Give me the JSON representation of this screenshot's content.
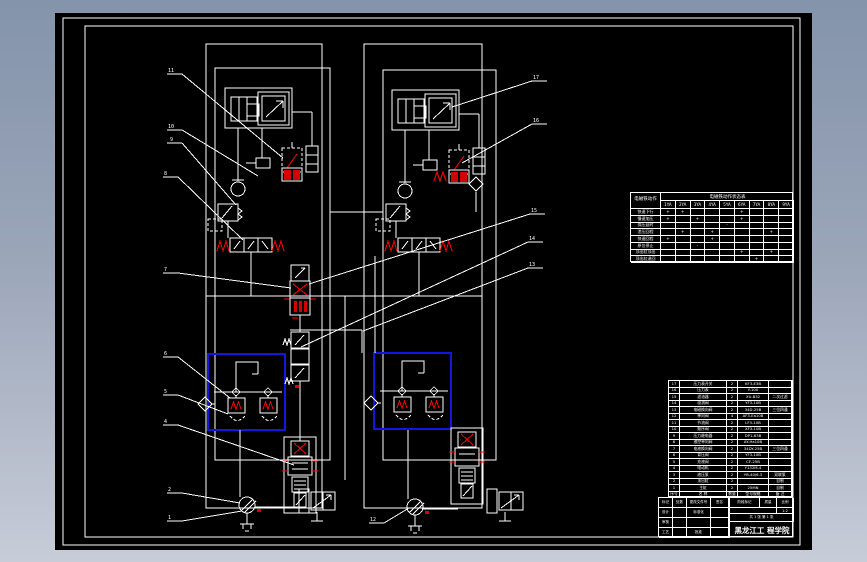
{
  "colors": {
    "background_top": "#8494ab",
    "background_bottom": "#c7ccd8",
    "paper": "#000000",
    "line": "#ffffff",
    "accent_red": "#ff0000",
    "highlight_blue": "#1515dd"
  },
  "callouts": [
    {
      "t": "11"
    },
    {
      "t": "10"
    },
    {
      "t": "9"
    },
    {
      "t": "8"
    },
    {
      "t": "7"
    },
    {
      "t": "6"
    },
    {
      "t": "5"
    },
    {
      "t": "4"
    },
    {
      "t": "2"
    },
    {
      "t": "1"
    },
    {
      "t": "17"
    },
    {
      "t": "16"
    },
    {
      "t": "15"
    },
    {
      "t": "14"
    },
    {
      "t": "13"
    },
    {
      "t": "12"
    }
  ],
  "action": {
    "corner": "电磁铁动作",
    "title": "电磁铁动作状态表",
    "head": [
      [
        "1YA",
        "2YA",
        "3YA",
        "4YA",
        "5YA",
        "6YA",
        "7YA",
        "8YA",
        "9YA"
      ]
    ],
    "rows": [
      [
        "快速下行",
        "+",
        "+",
        "",
        "",
        "",
        "+",
        "",
        "",
        ""
      ],
      [
        "慢速加压",
        "+",
        "",
        "+",
        "",
        "",
        "+",
        "",
        "",
        ""
      ],
      [
        "保压延时",
        "",
        "",
        "",
        "",
        "-",
        "",
        "",
        "",
        ""
      ],
      [
        "泄压回程",
        "",
        "+",
        "",
        "+",
        "",
        "",
        "",
        "+",
        ""
      ],
      [
        "快速回程",
        "+",
        "",
        "",
        "+",
        "",
        "",
        "",
        "",
        ""
      ],
      [
        "原位停止",
        "",
        "",
        "-",
        "",
        "",
        "",
        "",
        "",
        ""
      ],
      [
        "顶出缸顶出",
        "",
        "",
        "",
        "",
        "",
        "+",
        "",
        "+",
        ""
      ],
      [
        "顶出缸退回",
        "",
        "",
        "",
        "",
        "",
        "",
        "+",
        "",
        ""
      ]
    ]
  },
  "parts": {
    "rows": [
      [
        "17",
        "压力表开关",
        "2",
        "KF3-E3B",
        ""
      ],
      [
        "16",
        "压力表",
        "2",
        "Y-100",
        ""
      ],
      [
        "15",
        "滤油器",
        "2",
        "XU-B32",
        "二次过滤"
      ],
      [
        "14",
        "溢流阀",
        "2",
        "YF3-10B",
        ""
      ],
      [
        "13",
        "电磁换向阀",
        "2",
        "34D-25B",
        "三位四通"
      ],
      [
        "12",
        "单向阀",
        "4",
        "AF3-Ea10B",
        ""
      ],
      [
        "11",
        "节流阀",
        "2",
        "LF3-10B",
        ""
      ],
      [
        "10",
        "顺序阀",
        "2",
        "XF3-10B",
        ""
      ],
      [
        "9",
        "压力继电器",
        "2",
        "DP1-63B",
        ""
      ],
      [
        "8",
        "液控单向阀",
        "2",
        "AY-Ha10B",
        ""
      ],
      [
        "7",
        "电液换向阀",
        "2",
        "34DY-25B",
        "三位四通"
      ],
      [
        "6",
        "背压阀",
        "2",
        "YF3-10B",
        ""
      ],
      [
        "5",
        "充液阀",
        "2",
        "CF-25B",
        ""
      ],
      [
        "4",
        "电动机",
        "2",
        "Y132M-4",
        ""
      ],
      [
        "3",
        "液压泵",
        "2",
        "YB-40/6.3",
        "双联泵"
      ],
      [
        "2",
        "顶出缸",
        "2",
        "",
        "自制"
      ],
      [
        "1",
        "主缸",
        "2",
        "25MN",
        "自制"
      ],
      [
        "序号",
        "名  称",
        "数量",
        "型号规格",
        "备 注"
      ]
    ]
  },
  "titleblock": {
    "left_rows": [
      [
        "标记",
        "处数",
        "更改文件号",
        "签名"
      ],
      [
        "设计",
        "",
        "标准化",
        ""
      ],
      [
        "审核",
        "",
        "",
        ""
      ],
      [
        "工艺",
        "",
        "批准",
        ""
      ]
    ],
    "stage_label": "阶段标记",
    "mass_label": "质量",
    "scale_label": "比例",
    "scale_value": "1:2",
    "sheets": "共 1 张 第 1 张",
    "org": "黑龙江工 程学院"
  }
}
